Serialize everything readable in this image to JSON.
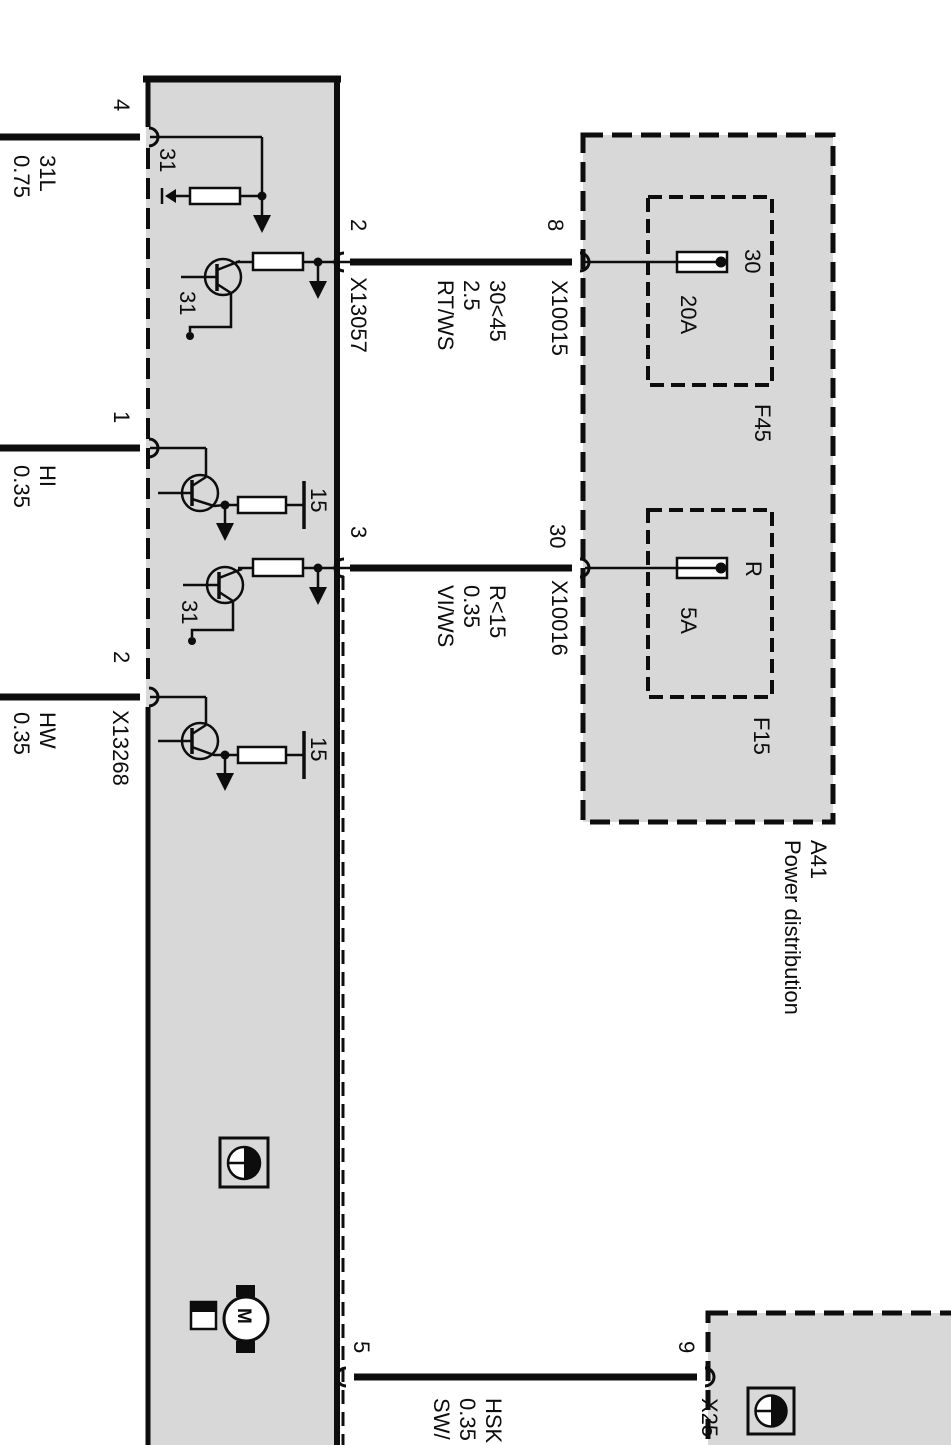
{
  "colors": {
    "module_fill": "#d8d8d8",
    "line": "#0d0d0d",
    "background": "#ffffff"
  },
  "module": {
    "left_pins": [
      {
        "pin": "4",
        "wire_lines": [
          "31L",
          "0.75"
        ]
      },
      {
        "pin": "1",
        "wire_lines": [
          "HI",
          "0.35"
        ]
      },
      {
        "pin": "2",
        "connector": "X13268",
        "wire_lines": [
          "HW",
          "0.35"
        ]
      }
    ],
    "right_pins": [
      {
        "pin": "2",
        "connector": "X13057",
        "wire_lines": [
          "30<45",
          "2.5",
          "RT/WS"
        ],
        "dest_pin": "8",
        "dest_connector": "X10015"
      },
      {
        "pin": "3",
        "wire_lines": [
          "R<15",
          "0.35",
          "VI/WS"
        ],
        "dest_pin": "30",
        "dest_connector": "X10016"
      },
      {
        "pin": "5",
        "wire_lines": [
          "HSK",
          "0.35",
          "SW/"
        ],
        "dest_pin": "9",
        "dest_connector": "X25"
      }
    ],
    "terminals": {
      "ground_1": "31",
      "ground_2": "31",
      "ground_3": "31",
      "term15_1": "15",
      "term15_2": "15"
    },
    "motor_label": "M"
  },
  "a41": {
    "id": "A41",
    "name": "Power distribution",
    "fuses": [
      {
        "id": "F45",
        "rating": "20A",
        "terminal": "30"
      },
      {
        "id": "F15",
        "rating": "5A",
        "terminal": "R"
      }
    ]
  }
}
